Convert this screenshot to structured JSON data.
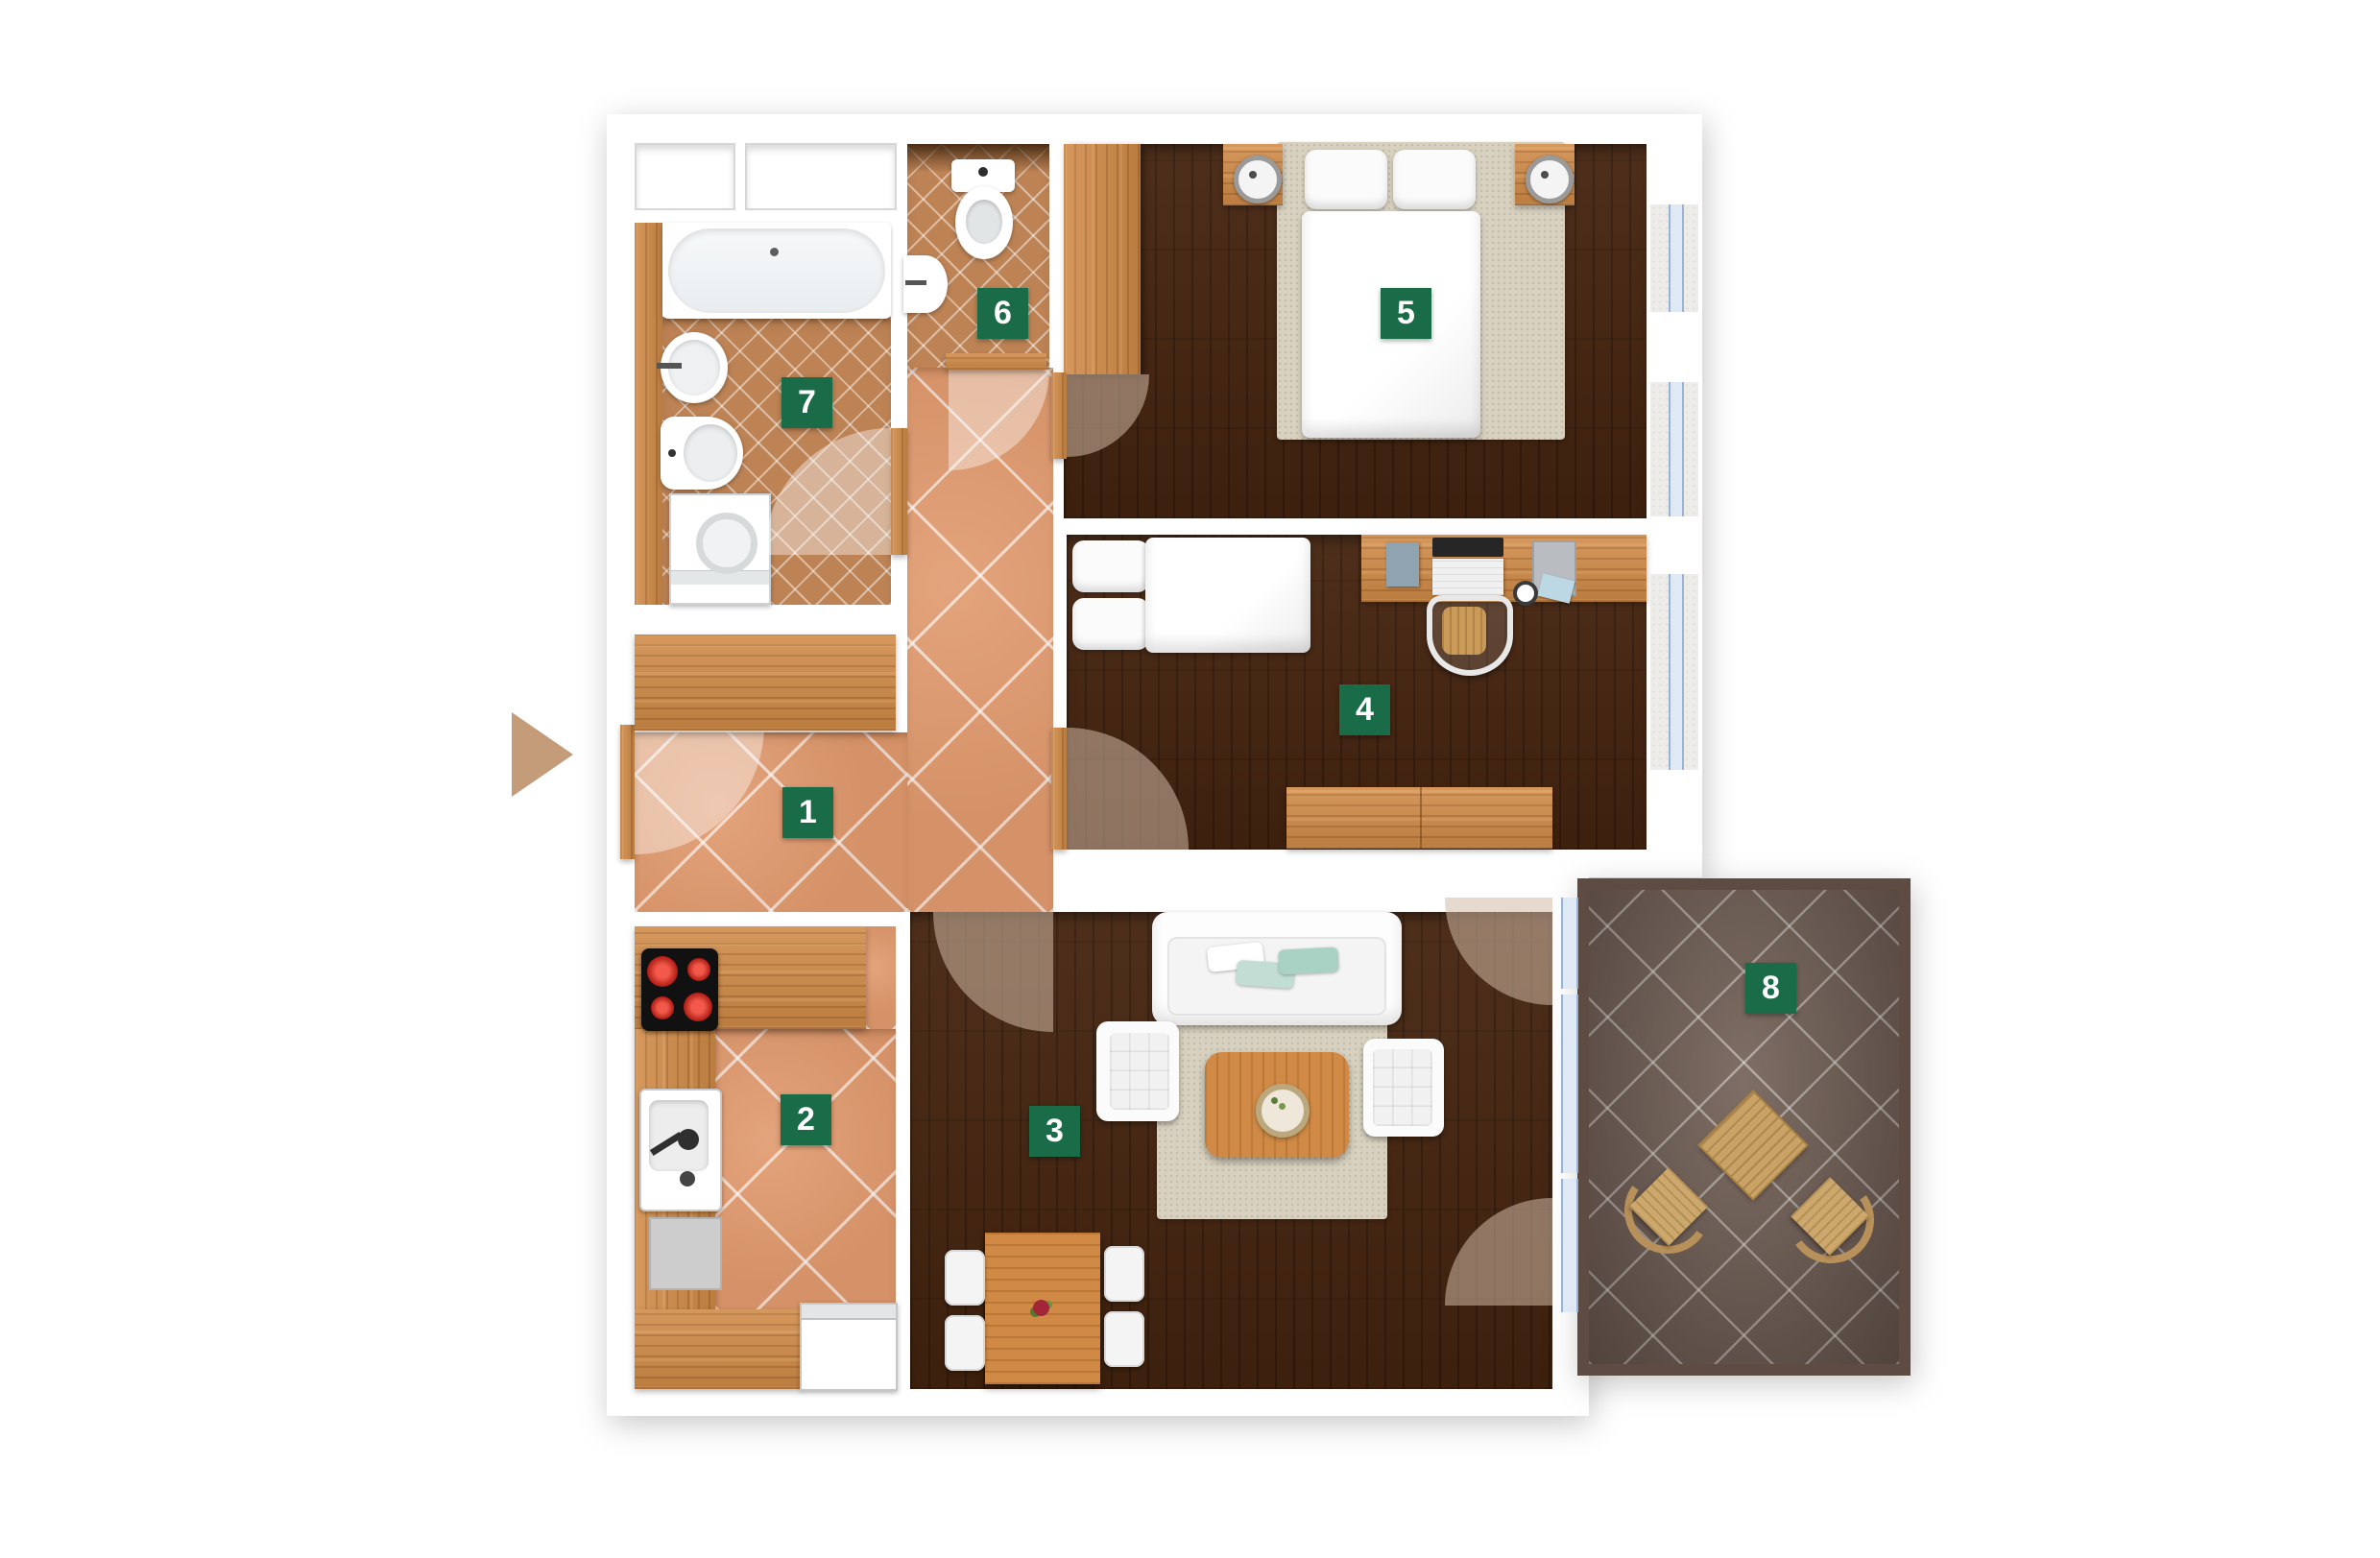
{
  "floorplan": {
    "type": "apartment-floor-plan-top-view",
    "accent_color": "#1a6b47",
    "label_text_color": "#ffffff",
    "rooms": [
      {
        "number": "1",
        "name": "hallway"
      },
      {
        "number": "2",
        "name": "kitchen"
      },
      {
        "number": "3",
        "name": "living-room"
      },
      {
        "number": "4",
        "name": "bedroom-study"
      },
      {
        "number": "5",
        "name": "bedroom"
      },
      {
        "number": "6",
        "name": "wc"
      },
      {
        "number": "7",
        "name": "bathroom"
      },
      {
        "number": "8",
        "name": "balcony"
      }
    ],
    "icons": {
      "entrance_arrow": "right-pointing-triangle"
    },
    "colors": {
      "tile_terracotta": "#bd8355",
      "tile_hall": "#e0996d",
      "wood": "#d08a46",
      "floor_dark": "#45240f",
      "balcony_tile": "#705e54",
      "balcony_frame": "#5e4b41",
      "window_glass": "#dfe9f6",
      "entrance_arrow": "#c59c7a"
    }
  }
}
